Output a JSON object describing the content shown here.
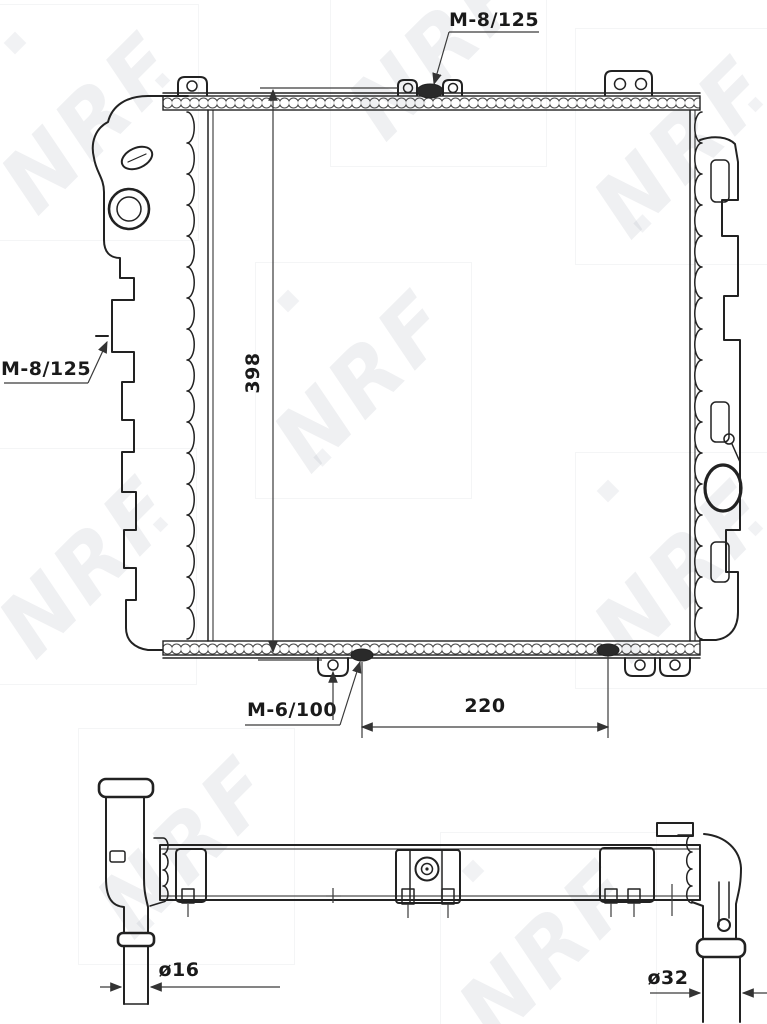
{
  "watermark": {
    "text": "NRF"
  },
  "colors": {
    "line": "#222222",
    "dimension": "#3a3a3a",
    "watermark": "#788490",
    "background": "#ffffff"
  },
  "front_view": {
    "labels": {
      "thread_top": "M-8/125",
      "thread_left": "M-8/125",
      "thread_bottom": "M-6/100"
    },
    "dimensions": {
      "height": "398",
      "bottom_width": "220"
    }
  },
  "side_view": {
    "dimensions": {
      "small_pipe_diameter": "ø16",
      "large_pipe_diameter": "ø32"
    }
  }
}
